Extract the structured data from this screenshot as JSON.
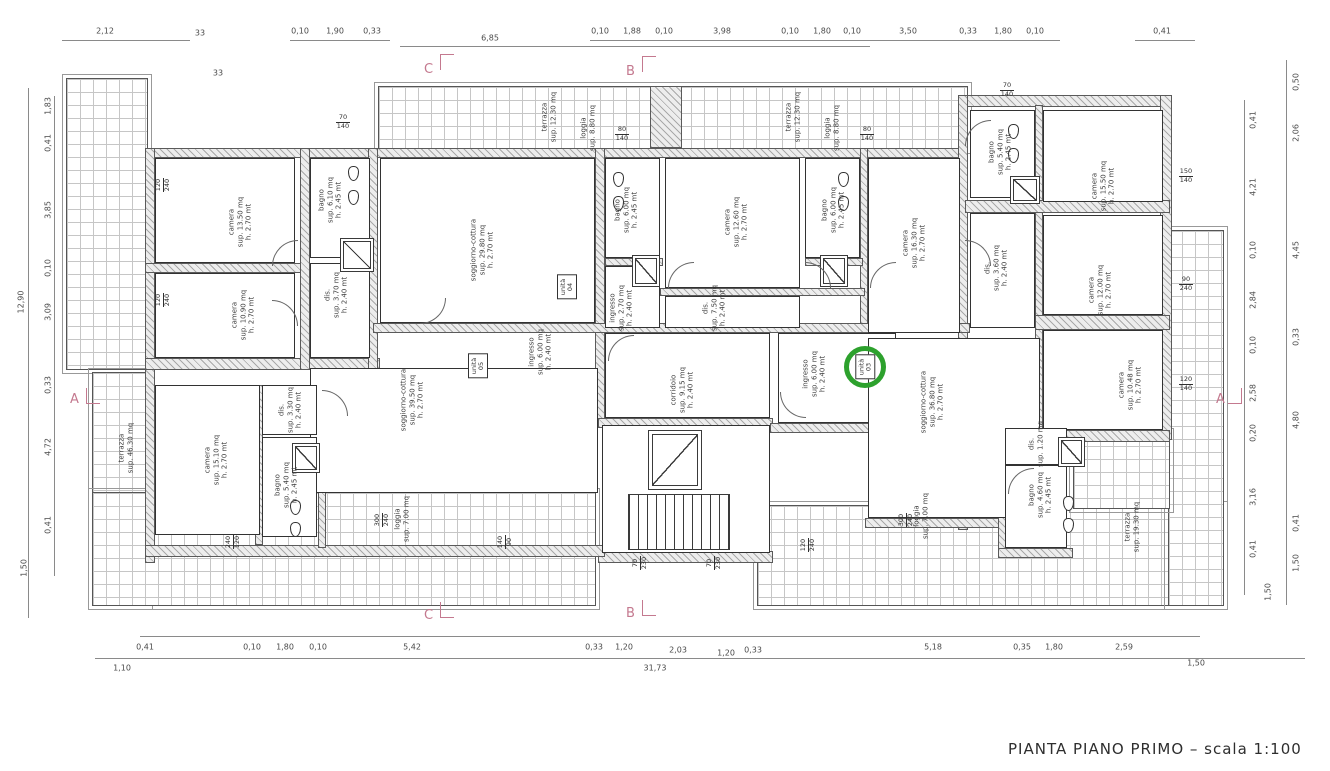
{
  "title": "PIANTA PIANO PRIMO – scala 1:100",
  "colors": {
    "section_marker": "#c4798f",
    "unit_highlight": "#2da12d",
    "line": "#3a3a3a"
  },
  "section_markers": {
    "top_c": "C",
    "top_b": "B",
    "left_a": "A",
    "right_a": "A",
    "bottom_c": "C",
    "bottom_b": "B"
  },
  "misc": {
    "n33a": "33",
    "n33b": "33"
  },
  "dims": {
    "top": [
      "2,12",
      "0,10",
      "1,90",
      "0,33",
      "6,85",
      "0,10",
      "1,88",
      "0,10",
      "3,98",
      "0,10",
      "1,80",
      "0,10",
      "3,50",
      "0,33",
      "1,80",
      "0,10",
      "0,41"
    ],
    "bottom1": [
      "0,41",
      "0,10",
      "1,80",
      "0,10",
      "5,42",
      "0,33",
      "1,20",
      "2,03",
      "1,20",
      "0,33",
      "5,18",
      "0,35",
      "1,80",
      "2,59"
    ],
    "bottom2": [
      "1,10",
      "31,73",
      "1,50"
    ],
    "left_inner": [
      "1,83",
      "0,41",
      "3,85",
      "0,10",
      "3,09",
      "0,33",
      "4,72",
      "0,41"
    ],
    "left_outer": [
      "12,90",
      "1,50"
    ],
    "right_inner": [
      "0,41",
      "4,21",
      "0,10",
      "2,84",
      "0,10",
      "2,58",
      "0,20",
      "3,16",
      "0,41"
    ],
    "right_outer": [
      "0,50",
      "2,06",
      "4,45",
      "0,33",
      "4,80",
      "0,41",
      "1,50",
      "1,50"
    ]
  },
  "rooms": {
    "camera_1350": {
      "name": "camera",
      "sup": "sup. 13.50 mq",
      "h": "h. 2.70 mt"
    },
    "camera_1090": {
      "name": "camera",
      "sup": "sup. 10.90 mq",
      "h": "h. 2.70 mt"
    },
    "bagno_610": {
      "name": "bagno",
      "sup": "sup. 6.10 mq",
      "h": "h. 2.45 mt"
    },
    "dis_370": {
      "name": "dis.",
      "sup": "sup. 3.70 mq",
      "h": "h. 2.40 mt"
    },
    "sogg_2980": {
      "name": "soggiorno-cottura",
      "sup": "sup. 29.80 mq",
      "h": "h. 2.70 mt"
    },
    "ingresso_600a": {
      "name": "ingresso",
      "sup": "sup. 6.00 mq",
      "h": "h. 2.40 mt"
    },
    "bagno_600a": {
      "name": "bagno",
      "sup": "sup. 6.00 mq",
      "h": "h. 2.45 mt"
    },
    "camera_1260": {
      "name": "camera",
      "sup": "sup. 12.60 mq",
      "h": "h. 2.70 mt"
    },
    "bagno_600b": {
      "name": "bagno",
      "sup": "sup. 6.00 mq",
      "h": "h. 2.45 mt"
    },
    "dis_750": {
      "name": "dis.",
      "sup": "sup. 7.50 mq",
      "h": "h. 2.40 mt"
    },
    "ingresso_270": {
      "name": "ingresso",
      "sup": "sup. 2.70 mq",
      "h": "h. 2.40 mt"
    },
    "corridoio_915": {
      "name": "corridoio",
      "sup": "sup. 9.15 mq",
      "h": "h. 2.40 mt"
    },
    "ingresso_600b": {
      "name": "ingresso",
      "sup": "sup. 6.00 mq",
      "h": "h. 2.40 mt"
    },
    "camera_1630": {
      "name": "camera",
      "sup": "sup. 16.30 mq",
      "h": "h. 2.70 mt"
    },
    "dis_360": {
      "name": "dis.",
      "sup": "sup. 3.60 mq",
      "h": "h. 2.40 mt"
    },
    "bagno_540a": {
      "name": "bagno",
      "sup": "sup. 5.40 mq",
      "h": "h. 2.45 mt"
    },
    "camera_1550": {
      "name": "camera",
      "sup": "sup. 15.50 mq",
      "h": "h. 2.70 mt"
    },
    "camera_1200": {
      "name": "camera",
      "sup": "sup. 12.00 mq",
      "h": "h. 2.70 mt"
    },
    "camera_1048": {
      "name": "camera",
      "sup": "sup. 10.48 mq",
      "h": "h. 2.70 mt"
    },
    "sogg_3680": {
      "name": "soggiorno-cottura",
      "sup": "sup. 36.80 mq",
      "h": "h. 2.70 mt"
    },
    "dis_120": {
      "name": "dis.",
      "sup": "sup. 1.20 mq",
      "h": ""
    },
    "bagno_460": {
      "name": "bagno",
      "sup": "sup. 4.60 mq",
      "h": "h. 2.45 mt"
    },
    "sogg_3950": {
      "name": "soggiorno-cottura",
      "sup": "sup. 39.50 mq",
      "h": "h. 2.70 mt"
    },
    "camera_1510": {
      "name": "camera",
      "sup": "sup. 15.10 mq",
      "h": "h. 2.70 mt"
    },
    "dis_330": {
      "name": "dis.",
      "sup": "sup. 3.30 mq",
      "h": "h. 2.40 mt"
    },
    "bagno_540b": {
      "name": "bagno",
      "sup": "sup. 5.40 mq",
      "h": "h. 2.45 mt"
    }
  },
  "outdoor": {
    "terrazza_1230a": {
      "name": "terrazza",
      "sup": "sup. 12.30 mq"
    },
    "loggia_880a": {
      "name": "loggia",
      "sup": "sup. 8.80 mq"
    },
    "terrazza_1230b": {
      "name": "terrazza",
      "sup": "sup. 12.30 mq"
    },
    "loggia_880b": {
      "name": "loggia",
      "sup": "sup. 8.80 mq"
    },
    "terrazza_4630": {
      "name": "terrazza",
      "sup": "sup. 46.30 mq"
    },
    "terrazza_1930": {
      "name": "terrazza",
      "sup": "sup. 19.30 mq"
    },
    "loggia_700a": {
      "name": "loggia",
      "sup": "sup. 7.00 mq"
    },
    "loggia_700b": {
      "name": "loggia",
      "sup": "sup. 7.00 mq"
    }
  },
  "units": {
    "u03": {
      "l1": "unità",
      "l2": "03"
    },
    "u04": {
      "l1": "unità",
      "l2": "04"
    },
    "u05": {
      "l1": "unità",
      "l2": "05"
    }
  },
  "wtags": [
    {
      "a": "120",
      "b": "240"
    },
    {
      "a": "120",
      "b": "240"
    },
    {
      "a": "70",
      "b": "140"
    },
    {
      "a": "80",
      "b": "140"
    },
    {
      "a": "80",
      "b": "140"
    },
    {
      "a": "70",
      "b": "140"
    },
    {
      "a": "150",
      "b": "140"
    },
    {
      "a": "90",
      "b": "240"
    },
    {
      "a": "120",
      "b": "140"
    },
    {
      "a": "240",
      "b": "120"
    },
    {
      "a": "140",
      "b": "90"
    },
    {
      "a": "70",
      "b": "230"
    },
    {
      "a": "70",
      "b": "230"
    },
    {
      "a": "300",
      "b": "240"
    },
    {
      "a": "300",
      "b": "240"
    },
    {
      "a": "120",
      "b": "240"
    }
  ]
}
